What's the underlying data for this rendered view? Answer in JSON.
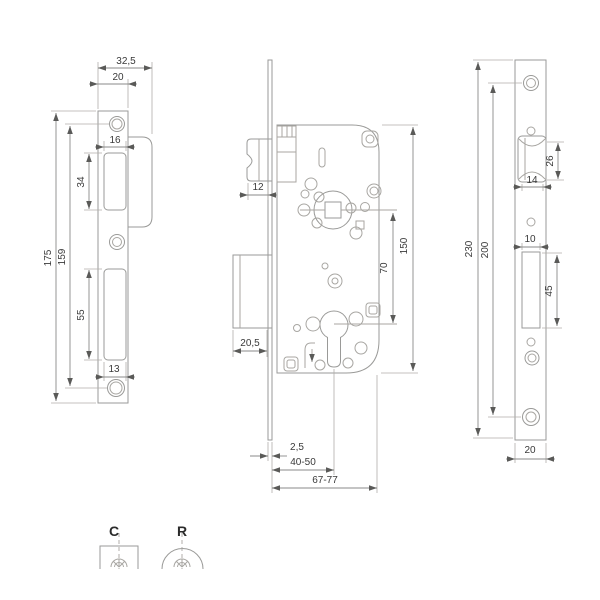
{
  "drawing": {
    "type": "technical-drawing",
    "subject": "mortise-lock",
    "line_color": "#9a9a98",
    "text_color": "#3a3a3a",
    "strike_plate": {
      "total_width": "32,5",
      "plate_width": "20",
      "latch_opening_width": "16",
      "latch_opening_height": "34",
      "total_height": "175",
      "screw_hole_spacing": "159",
      "bolt_opening_height": "55",
      "bolt_opening_width": "13"
    },
    "lock_body": {
      "latch_projection": "12",
      "bolt_throw": "20,5",
      "faceplate_thickness": "2,5",
      "backset": "40-50",
      "case_depth": "67-77",
      "axis_distance": "70",
      "case_height": "150"
    },
    "faceplate": {
      "total_height": "230",
      "screw_hole_spacing": "200",
      "latch_height": "26",
      "latch_width": "14",
      "bolt_width": "10",
      "bolt_height": "45",
      "plate_width": "20"
    },
    "symbols": {
      "square_forend": "C",
      "rounded_forend": "R"
    }
  }
}
